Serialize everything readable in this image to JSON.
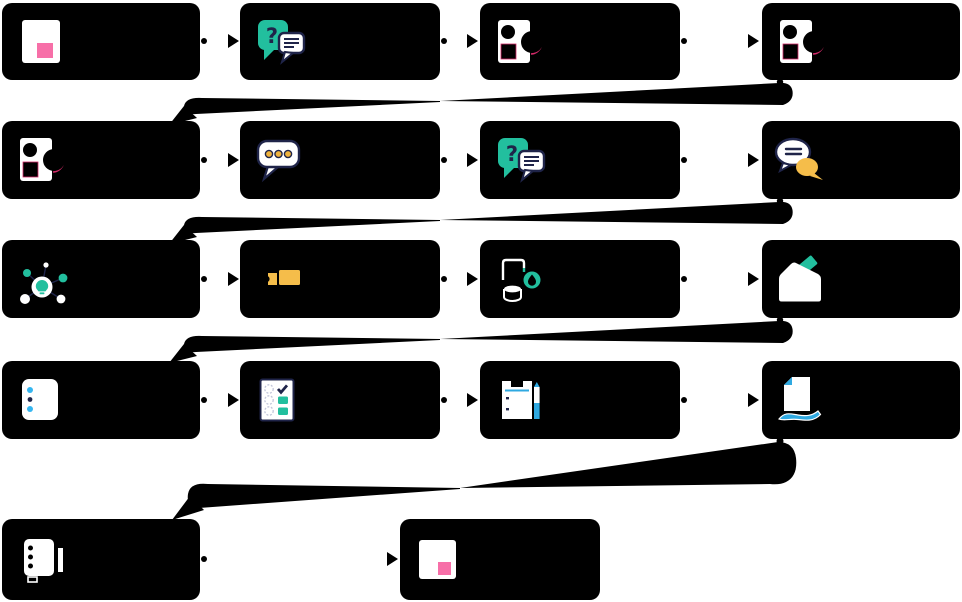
{
  "diagram": {
    "kind": "flowchart",
    "background": "#ffffff",
    "node_color": "#000000",
    "node_text_visible": false,
    "rows": [
      {
        "steps": [
          {
            "label": "",
            "icon": "note-icon"
          },
          {
            "label": "",
            "icon": "question-chat-icon"
          },
          {
            "label": "",
            "icon": "contact-card-icon"
          },
          {
            "label": "",
            "icon": "contact-card-icon"
          }
        ]
      },
      {
        "steps": [
          {
            "label": "",
            "icon": "contact-card-icon"
          },
          {
            "label": "",
            "icon": "typing-bubble-icon"
          },
          {
            "label": "",
            "icon": "question-chat-icon"
          },
          {
            "label": "",
            "icon": "chat-exchange-icon"
          }
        ]
      },
      {
        "steps": [
          {
            "label": "",
            "icon": "idea-icon"
          },
          {
            "label": "",
            "icon": "ticket-icon"
          },
          {
            "label": "",
            "icon": "objects-pin-icon"
          },
          {
            "label": "",
            "icon": "ballot-box-icon"
          }
        ]
      },
      {
        "steps": [
          {
            "label": "",
            "icon": "list-icon"
          },
          {
            "label": "",
            "icon": "checklist-icon"
          },
          {
            "label": "",
            "icon": "clipboard-pencil-icon"
          },
          {
            "label": "",
            "icon": "document-hand-icon"
          }
        ]
      },
      {
        "steps": [
          {
            "label": "",
            "icon": "notebook-icon"
          },
          {
            "label": "",
            "icon": "note-icon"
          }
        ]
      }
    ],
    "connectors": {
      "within_row": "small dot at source, solid triangular arrowhead at target, flowing left to right",
      "between_rows": "thick tapered black ribbon swoosh from last node of a row down-left to first node of next row"
    },
    "palette": {
      "teal": "#22bf9e",
      "pink": "#f76fa8",
      "yellow": "#f5bd4a",
      "yellow_dot": "#eeb23c",
      "navy": "#1f2449",
      "blue": "#2fa9e1",
      "cyan": "#35b6f0",
      "crimson": "#d42a69",
      "white": "#ffffff",
      "black": "#000000"
    }
  }
}
